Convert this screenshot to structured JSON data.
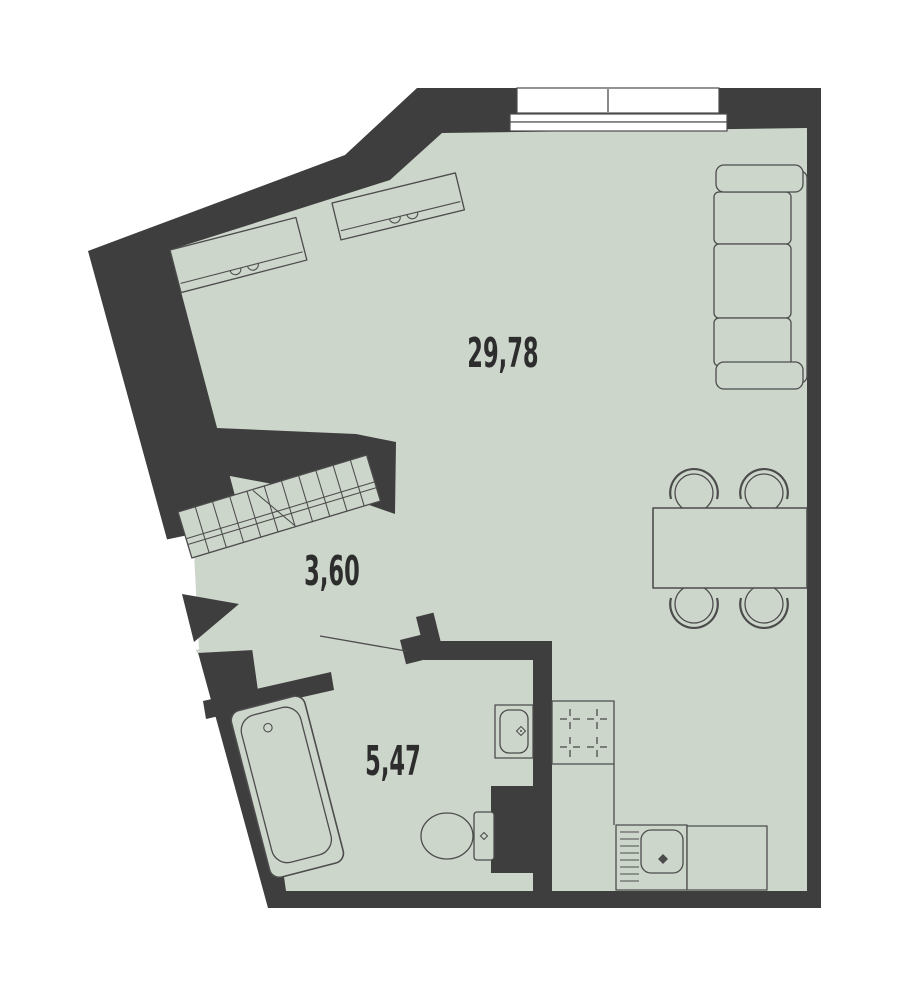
{
  "page": {
    "type": "apartment-floor-plan"
  },
  "plan": {
    "rooms": [
      {
        "name": "living-room-kitchen",
        "area_label": "29,78"
      },
      {
        "name": "hall",
        "area_label": "3,60"
      },
      {
        "name": "bathroom",
        "area_label": "5,47"
      }
    ],
    "colors": {
      "floor": "#cdd6cb",
      "wall": "#3e3e3e",
      "fixture_outline": "#4c4c4c",
      "label_text": "#2d2d2d",
      "background": "#ffffff",
      "window_fill": "#ffffff"
    },
    "fixtures": [
      {
        "name": "window"
      },
      {
        "name": "wardrobe-cabinet-left"
      },
      {
        "name": "wardrobe-cabinet-right"
      },
      {
        "name": "sofa"
      },
      {
        "name": "dining-table"
      },
      {
        "name": "chairs",
        "count": 4
      },
      {
        "name": "staircase"
      },
      {
        "name": "entrance-arrow"
      },
      {
        "name": "interior-door-leaf"
      },
      {
        "name": "bathtub"
      },
      {
        "name": "washbasin"
      },
      {
        "name": "toilet"
      },
      {
        "name": "stove"
      },
      {
        "name": "kitchen-sink"
      },
      {
        "name": "countertop"
      }
    ]
  }
}
